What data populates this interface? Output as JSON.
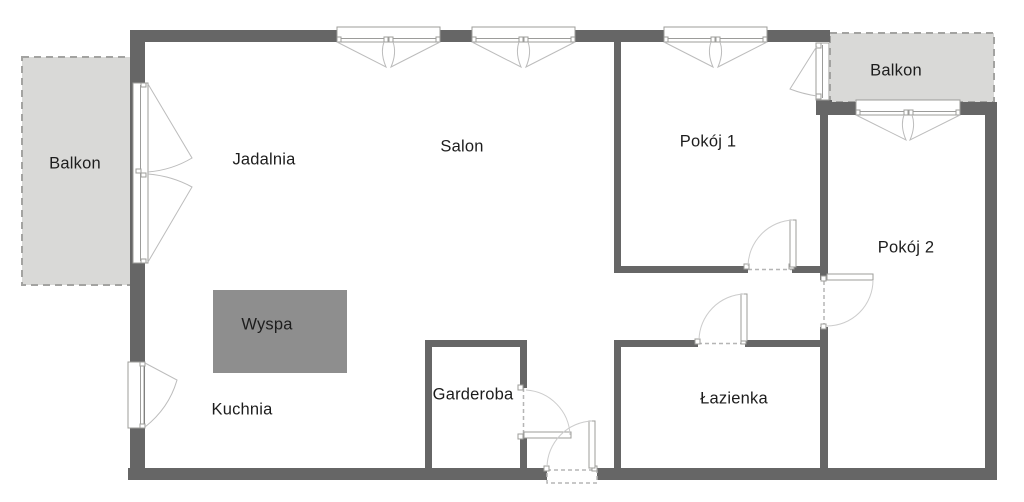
{
  "page": {
    "background": "#ffffff"
  },
  "colors": {
    "page_bg": "#ffffff",
    "wall": "#666666",
    "balcony_fill": "#d9d9d7",
    "balcony_border": "#a3a3a1",
    "island_fill": "#8e8e8e",
    "window_fill": "#ffffff",
    "frame_stroke": "#9c9c9a",
    "swing_stroke": "#bcbcbc",
    "arc_stroke": "#cccccc",
    "dash_stroke": "#b5b5b5",
    "label_text": "#1d1d1d"
  },
  "rooms": {
    "balkon_left": {
      "label": "Balkon"
    },
    "jadalnia": {
      "label": "Jadalnia"
    },
    "salon": {
      "label": "Salon"
    },
    "pokoj_1": {
      "label": "Pokój 1"
    },
    "balkon_right": {
      "label": "Balkon"
    },
    "pokoj_2": {
      "label": "Pokój 2"
    },
    "kuchnia": {
      "label": "Kuchnia"
    },
    "garderoba": {
      "label": "Garderoba"
    },
    "lazienka": {
      "label": "Łazienka"
    }
  },
  "fixtures": {
    "island": {
      "label": "Wyspa"
    }
  }
}
